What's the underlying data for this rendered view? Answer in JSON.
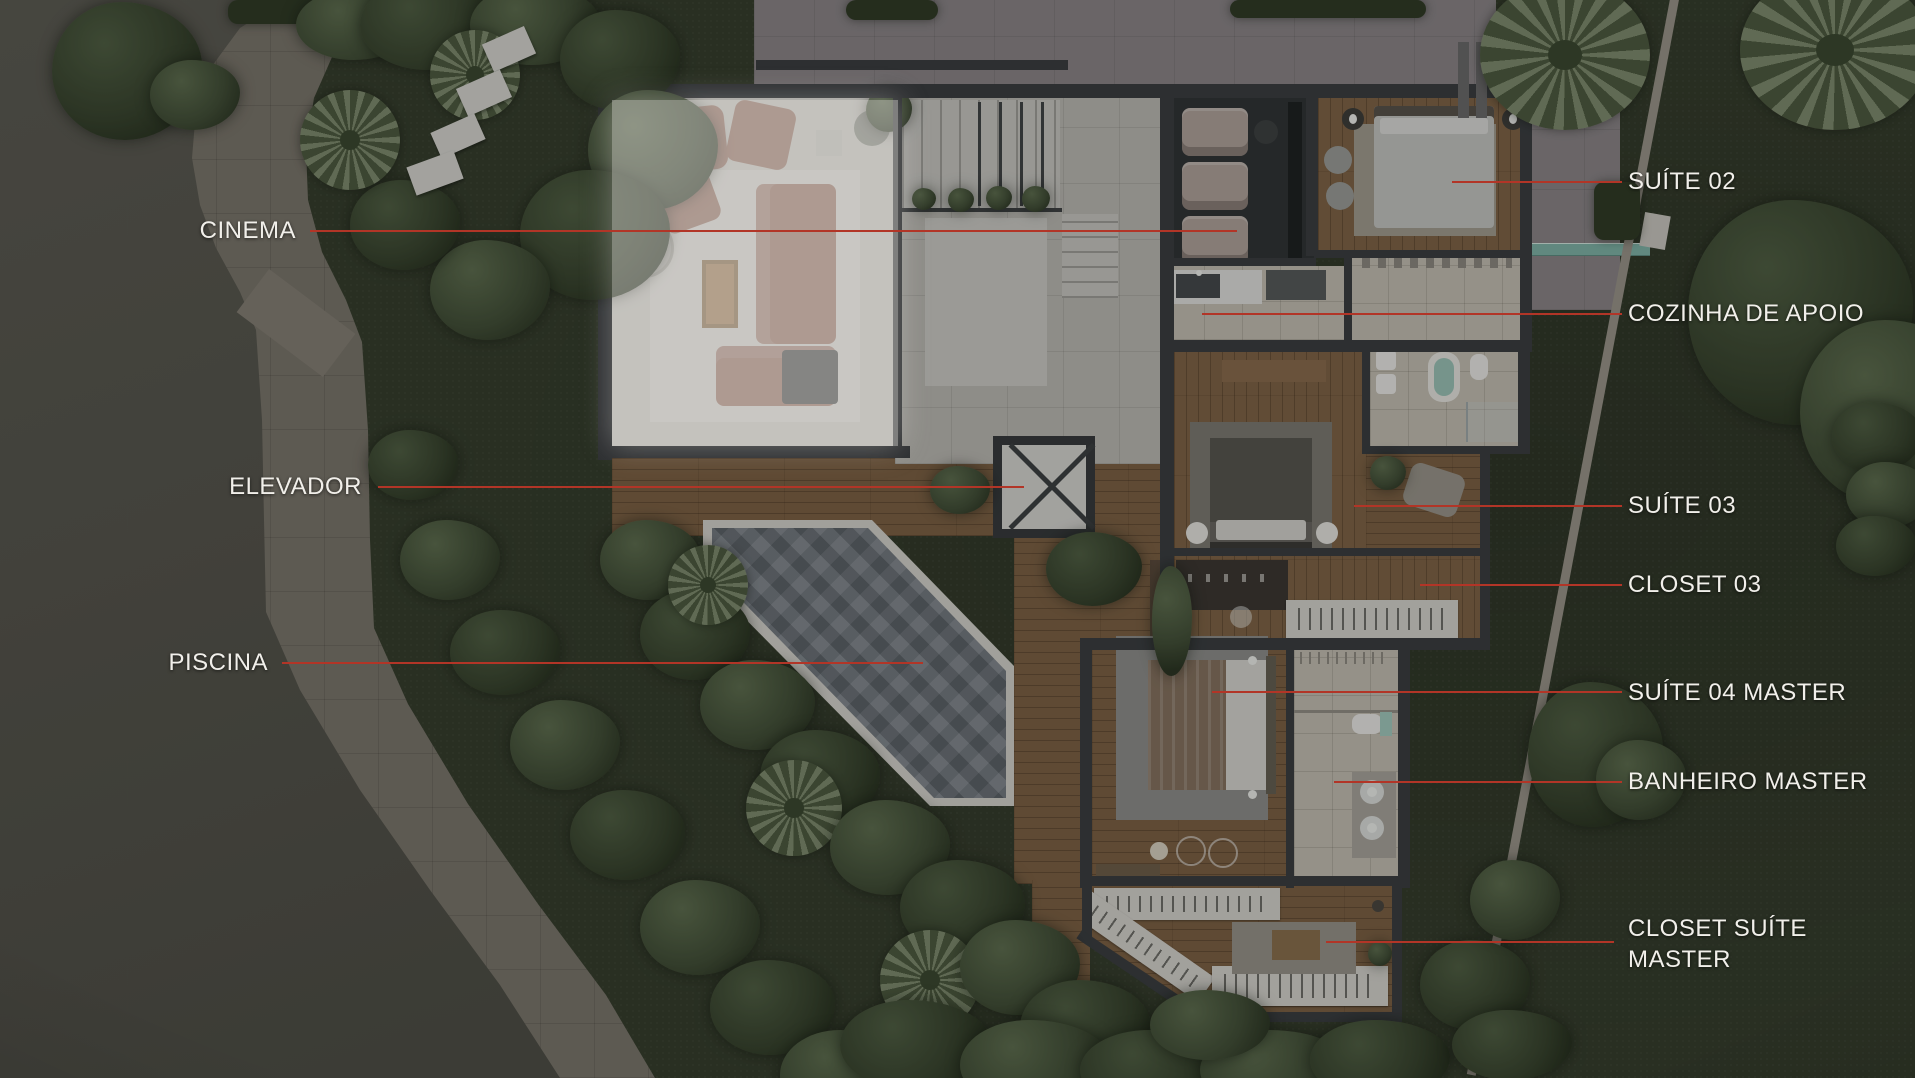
{
  "labels": {
    "left": [
      {
        "id": "cinema",
        "text": "CINEMA"
      },
      {
        "id": "elevador",
        "text": "ELEVADOR"
      },
      {
        "id": "piscina",
        "text": "PISCINA"
      }
    ],
    "right": [
      {
        "id": "suite-02",
        "text": "SUÍTE 02"
      },
      {
        "id": "cozinha-de-apoio",
        "text": "COZINHA DE APOIO"
      },
      {
        "id": "suite-03",
        "text": "SUÍTE 03"
      },
      {
        "id": "closet-03",
        "text": "CLOSET 03"
      },
      {
        "id": "suite-04-master",
        "text": "SUÍTE 04 MASTER"
      },
      {
        "id": "banheiro-master",
        "text": "BANHEIRO MASTER"
      },
      {
        "id": "closet-suite-master",
        "text": "CLOSET SUÍTE MASTER"
      }
    ]
  },
  "colors": {
    "leader_line": "#b23527",
    "label_text": "#f1efea"
  }
}
